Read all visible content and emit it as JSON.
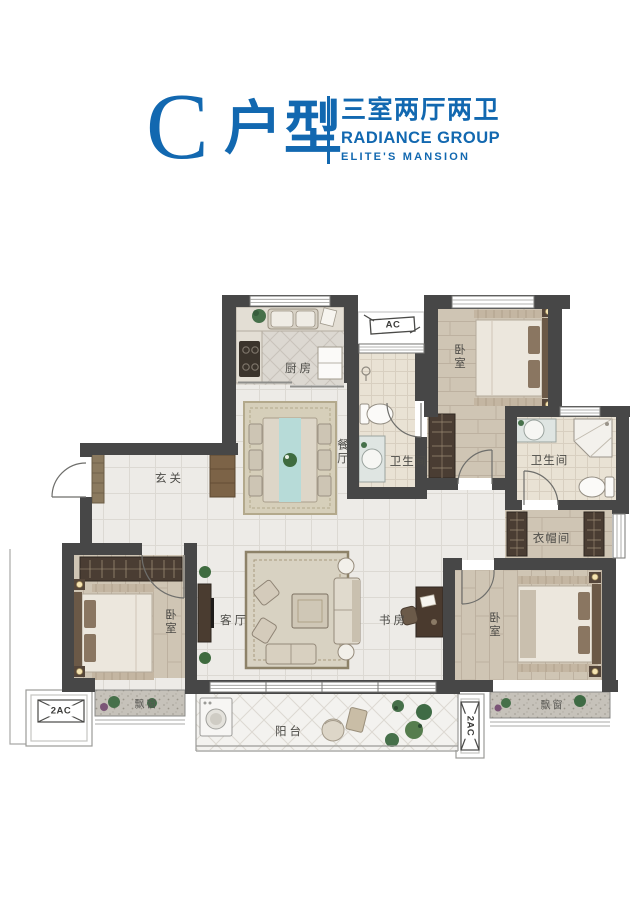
{
  "header": {
    "unit_letter": "C",
    "unit_type_suffix": "户型",
    "layout_spec": "三室两厅两卫",
    "brand_name": "RADIANCE GROUP",
    "brand_tagline": "ELITE'S MANSION",
    "accent_color": "#1268b0"
  },
  "plan": {
    "room_labels": {
      "kitchen": "厨房",
      "dining": "餐厅",
      "entry": "玄关",
      "bathroom": "卫生间",
      "bedroom": "卧室",
      "cloakroom": "衣帽间",
      "study": "书房",
      "living": "客厅",
      "balcony": "阳台",
      "bay_window": "飘窗"
    },
    "equipment_labels": {
      "ac": "AC",
      "ac_2": "2AC"
    },
    "colors": {
      "wall": "#474747",
      "tile_floor": "#edebe7",
      "wood_floor": "#cfc5b4",
      "bath_floor": "#e9e2d4",
      "balcony_floor": "#f3f2ef",
      "bay_window": "#c6c2ba",
      "accent": "#1268b0"
    }
  }
}
